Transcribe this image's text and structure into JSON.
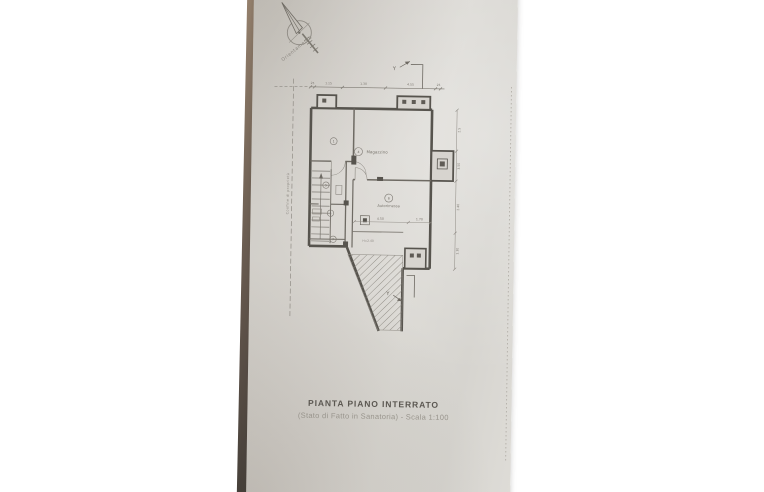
{
  "compass": {
    "caption": "Orientamento"
  },
  "boundary": {
    "annotation": "Confine di proprietà"
  },
  "markers": {
    "top": "Y",
    "bottom": "Y"
  },
  "dims": {
    "top": [
      "25",
      "1.15",
      "1.30",
      "4.55",
      "25"
    ],
    "right": [
      "2.5",
      "3.50",
      "2.40",
      "1.30"
    ],
    "room": [
      "4.50",
      "1.70"
    ],
    "height_note": "H=2.40"
  },
  "rooms": {
    "r1": {
      "num": "1"
    },
    "magazzino": {
      "num": "4",
      "label": "Magazzino"
    },
    "autorimessa": {
      "num": "8",
      "label": "Autorimessa"
    },
    "r5": {
      "num": "5"
    },
    "r6": {
      "num": "6"
    },
    "r7": {
      "num": "7"
    }
  },
  "title": {
    "line1": "PIANTA PIANO INTERRATO",
    "line2": "(Stato di Fatto in Sanatoria) - Scala 1:100"
  }
}
